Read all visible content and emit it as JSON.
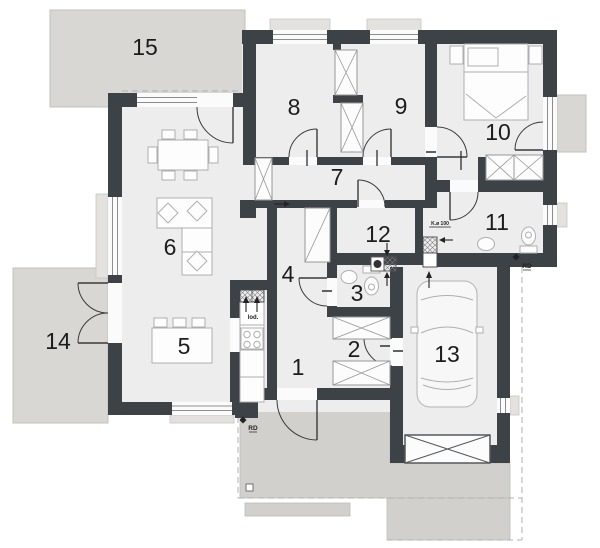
{
  "plan": {
    "rooms": [
      {
        "number": "1",
        "x": 298,
        "y": 367
      },
      {
        "number": "2",
        "x": 354,
        "y": 349
      },
      {
        "number": "3",
        "x": 357,
        "y": 293
      },
      {
        "number": "4",
        "x": 288,
        "y": 274
      },
      {
        "number": "5",
        "x": 184,
        "y": 346
      },
      {
        "number": "6",
        "x": 170,
        "y": 247
      },
      {
        "number": "7",
        "x": 337,
        "y": 177
      },
      {
        "number": "8",
        "x": 294,
        "y": 107
      },
      {
        "number": "9",
        "x": 401,
        "y": 106
      },
      {
        "number": "10",
        "x": 498,
        "y": 132
      },
      {
        "number": "11",
        "x": 497,
        "y": 222
      },
      {
        "number": "12",
        "x": 378,
        "y": 234
      },
      {
        "number": "13",
        "x": 447,
        "y": 354
      },
      {
        "number": "14",
        "x": 58,
        "y": 341
      },
      {
        "number": "15",
        "x": 145,
        "y": 47
      }
    ],
    "annotations": [
      {
        "id": "flue-label",
        "text": "K.ø 100",
        "x": 440,
        "y": 225,
        "size": 5,
        "underline": true
      },
      {
        "id": "rain-drain-south",
        "text": "RD",
        "x": 253,
        "y": 430,
        "size": 6.5,
        "underline": true
      },
      {
        "id": "rain-drain-east",
        "text": "RD",
        "x": 527,
        "y": 268,
        "size": 6.5,
        "underline": true
      },
      {
        "id": "fridge-label",
        "text": "lod.",
        "x": 253,
        "y": 319,
        "size": 6,
        "underline": false
      }
    ],
    "colors": {
      "wall": "#3d4247",
      "floor": "#ededee",
      "terrace": "#d8d7d4",
      "paving": "#d2d0cd",
      "furniture_line": "#aeaeb1",
      "storage_line": "#97979a",
      "door_line": "#3a3a3a",
      "glazing": "#8d8d90",
      "label": "#1c1c1c"
    }
  }
}
